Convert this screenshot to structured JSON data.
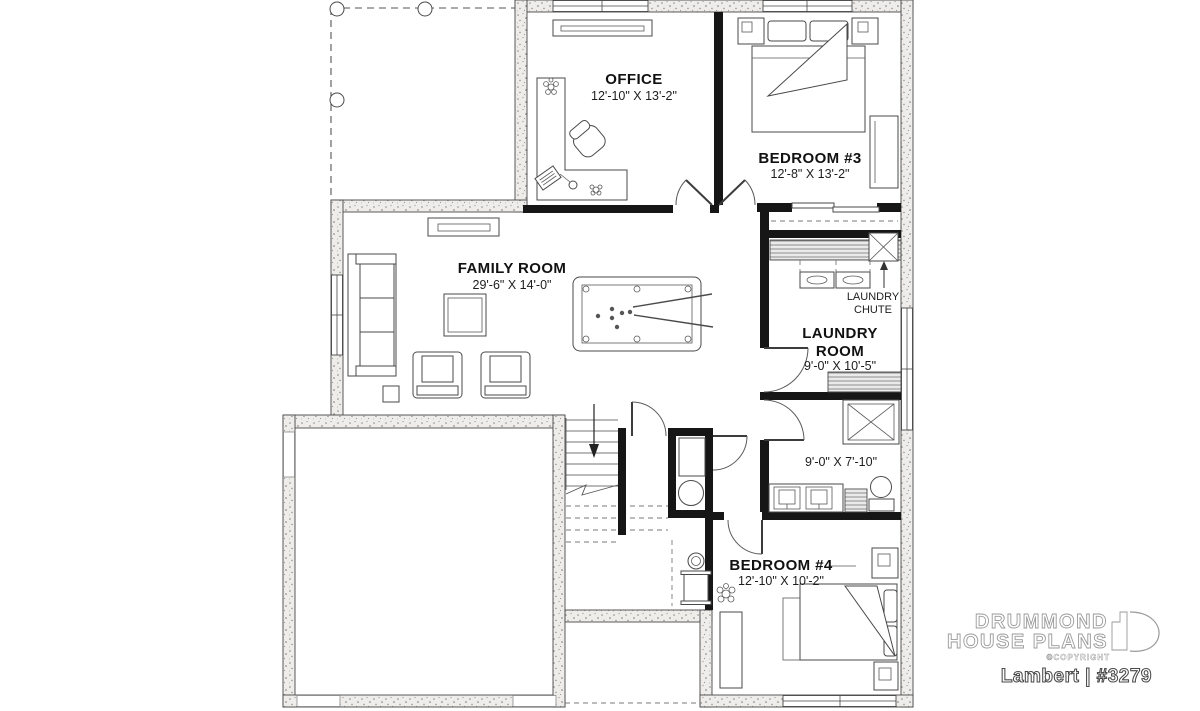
{
  "plan": {
    "rooms": {
      "office": {
        "name": "OFFICE",
        "dims": "12'-10\" X 13'-2\""
      },
      "bedroom3": {
        "name": "BEDROOM #3",
        "dims": "12'-8\" X 13'-2\""
      },
      "family_room": {
        "name": "FAMILY ROOM",
        "dims": "29'-6\" X 14'-0\""
      },
      "laundry_room": {
        "name_line1": "LAUNDRY",
        "name_line2": "ROOM",
        "dims": "9'-0\" X 10'-5\""
      },
      "bathroom": {
        "dims": "9'-0\" X 7'-10\""
      },
      "bedroom4": {
        "name": "BEDROOM #4",
        "dims": "12'-10\" X 10'-2\""
      }
    },
    "annotations": {
      "laundry_chute_line1": "LAUNDRY",
      "laundry_chute_line2": "CHUTE"
    }
  },
  "branding": {
    "logo_line1": "DRUMMOND",
    "logo_line2": "HOUSE PLANS",
    "copyright": "©COPYRIGHT",
    "plan_id": "Lambert | #3279"
  },
  "colors": {
    "wall_black": "#161616",
    "stipple_fill": "#efedea",
    "line": "#474747"
  }
}
